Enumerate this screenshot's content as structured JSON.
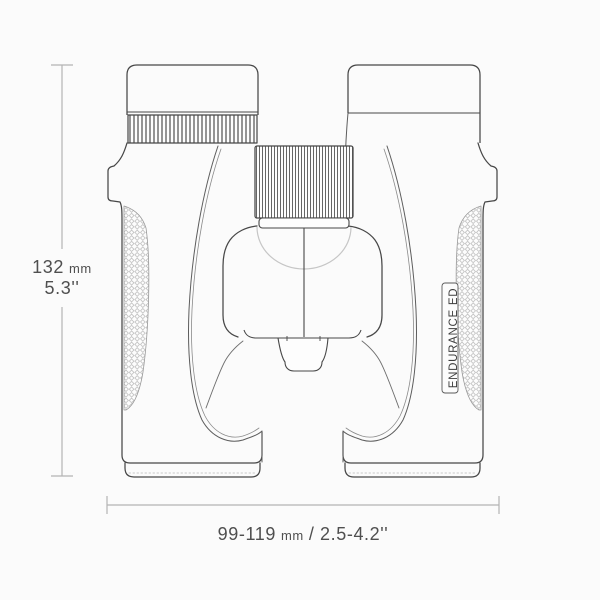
{
  "diagram": {
    "product_label": "ENDURANCE ED",
    "height_dimension": {
      "value": "132",
      "unit": "mm",
      "inches": "5.3''"
    },
    "width_dimension": {
      "value": "99-119",
      "unit": "mm",
      "inches": "/ 2.5-4.2''"
    },
    "colors": {
      "background": "#fbfbfb",
      "outline": "#474747",
      "secondary_line": "#7a7a7a",
      "light_line": "#c6c6c6",
      "texture": "#b5b5b5",
      "dimension_line": "#b4b4b4",
      "text": "#4f4f4f"
    }
  }
}
